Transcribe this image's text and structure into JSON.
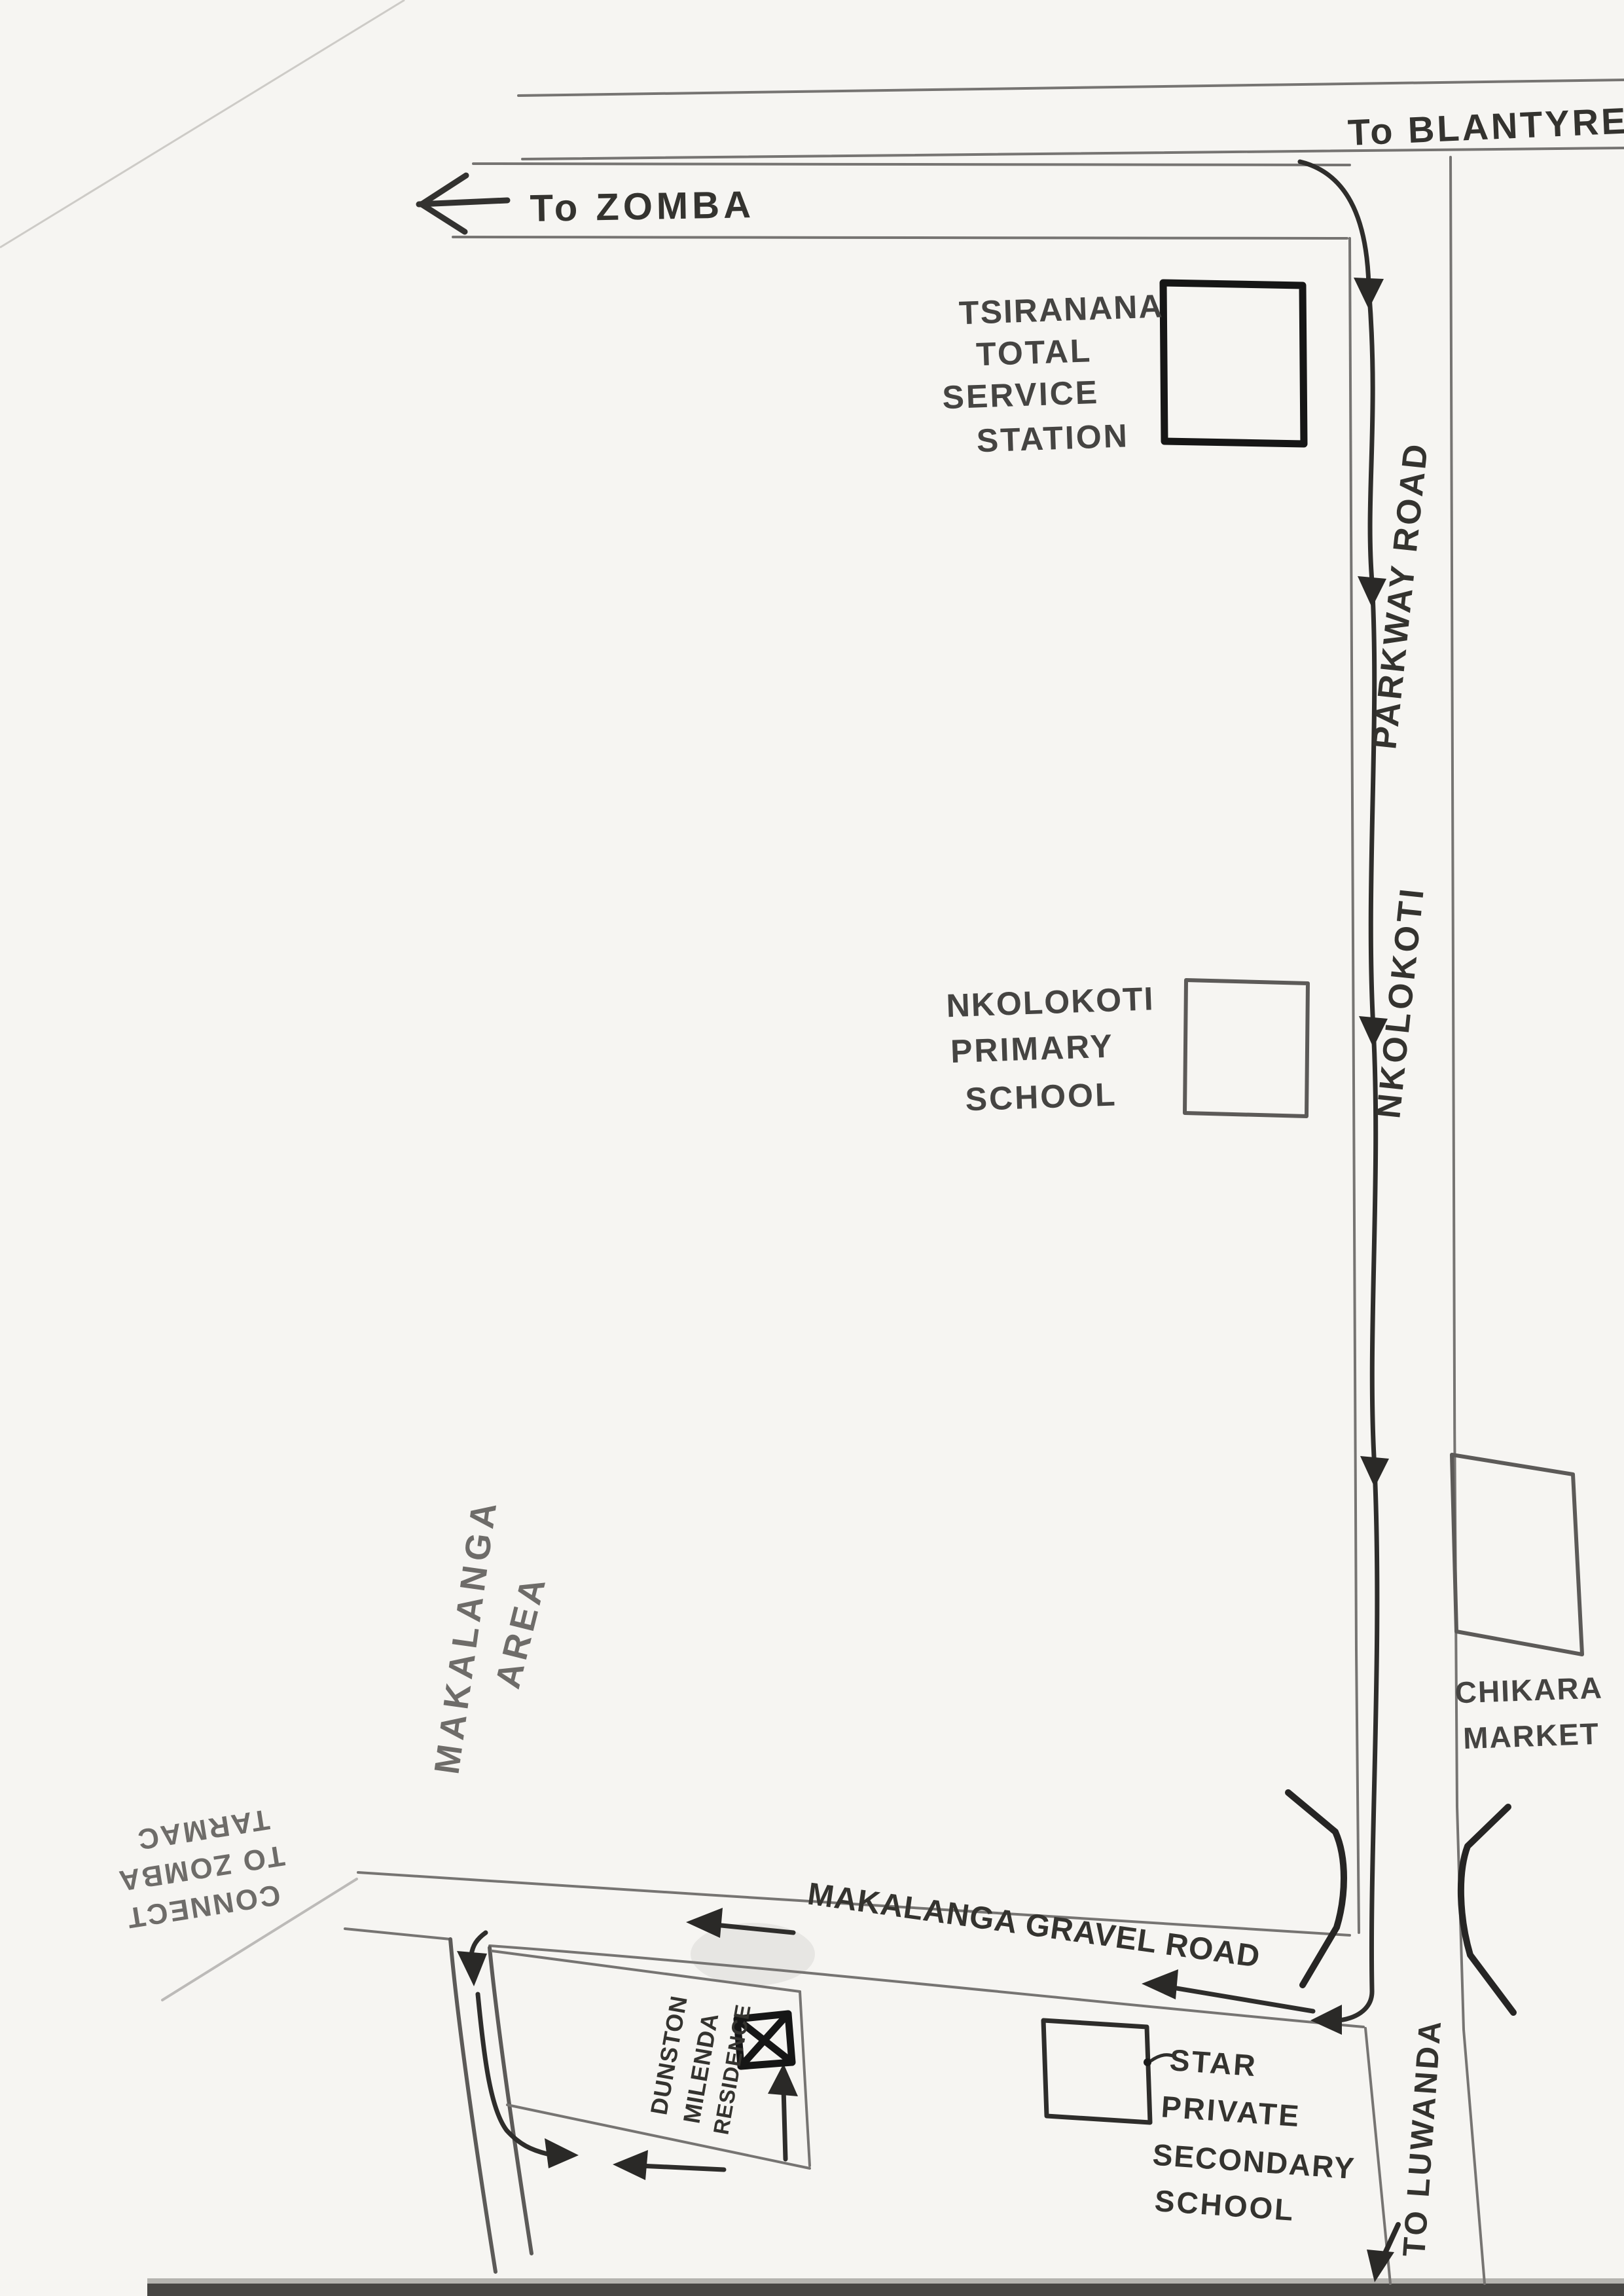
{
  "map": {
    "title": "Hand-drawn directions map",
    "destinations": {
      "to_blantyre": "To BLANTYRE",
      "to_zomba": "To ZOMBA",
      "to_luwanda": "TO LUWANDA",
      "connect_note": [
        "CONNECT",
        "TO ZOMBA",
        "TARMAC"
      ]
    },
    "roads": {
      "parkway_name_upper": "PARKWAY ROAD",
      "parkway_name_lower": "NKOLOKOTI",
      "gravel_name": "MAKALANGA GRAVEL ROAD"
    },
    "places": {
      "service_station": [
        "TSIRANANA",
        "TOTAL",
        "SERVICE",
        "STATION"
      ],
      "primary_school": [
        "NKOLOKOTI",
        "PRIMARY",
        "SCHOOL"
      ],
      "market": [
        "CHIKARA",
        "MARKET"
      ],
      "area": [
        "MAKALANGA",
        "AREA"
      ],
      "secondary_school": [
        "STAR",
        "PRIVATE",
        "SECONDARY",
        "SCHOOL"
      ],
      "residence": [
        "DUNSTON",
        "MILENDA",
        "RESIDENCE"
      ]
    },
    "colors": {
      "paper": "#f6f5f2",
      "pencil": "#767472",
      "marker": "#2e2d2b",
      "bold_ink": "#161616"
    }
  }
}
